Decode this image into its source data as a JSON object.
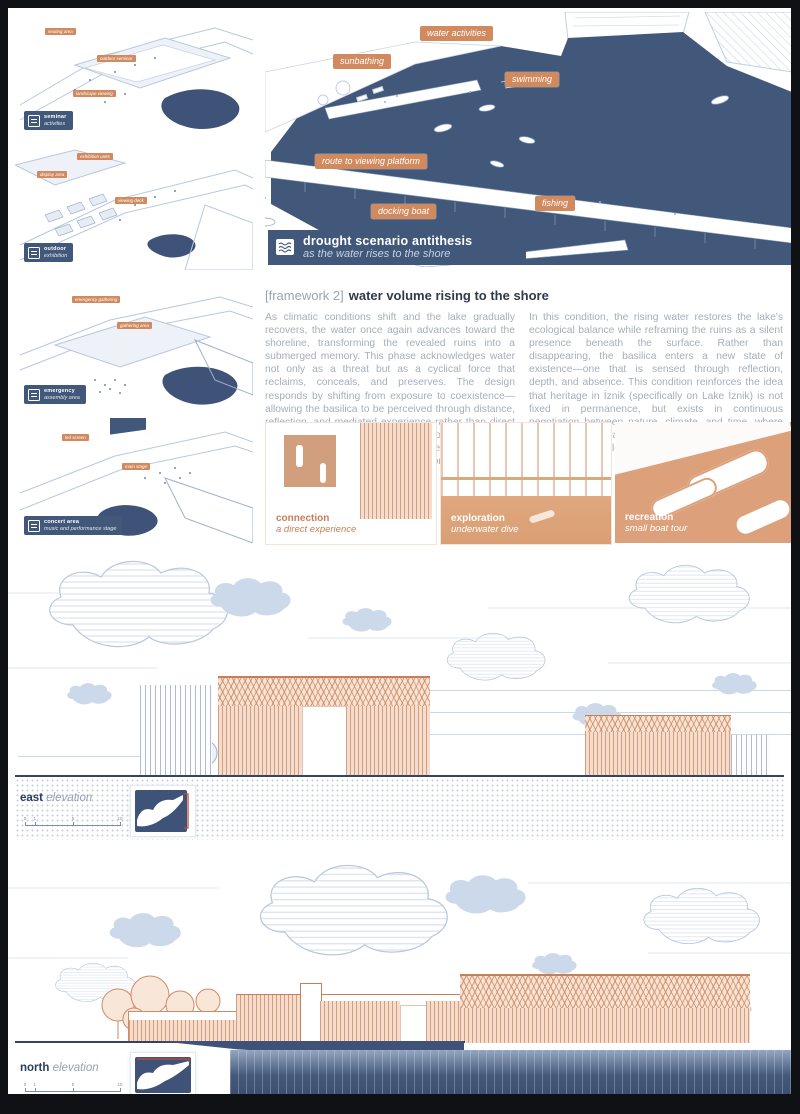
{
  "sidebar_thumbs": [
    {
      "badge": {
        "title": "seminar",
        "subtitle": "activities"
      },
      "tags": [
        "seating area",
        "outdoor seminar",
        "landscape viewing"
      ]
    },
    {
      "badge": {
        "title": "outdoor",
        "subtitle": "exhibition"
      },
      "tags": [
        "exhibition units",
        "display area",
        "viewing deck"
      ]
    },
    {
      "badge": {
        "title": "emergency",
        "subtitle": "assembly area"
      },
      "tags": [
        "emergency gathering",
        "gathering area"
      ]
    },
    {
      "badge": {
        "title": "concert area",
        "subtitle": "music and performance stage"
      },
      "tags": [
        "led screen",
        "main stage"
      ]
    }
  ],
  "main_diagram": {
    "tags": [
      {
        "label": "water activities"
      },
      {
        "label": "sunbathing"
      },
      {
        "label": "swimming"
      },
      {
        "label": "route to viewing platform"
      },
      {
        "label": "docking boat"
      },
      {
        "label": "fishing"
      }
    ],
    "banner": {
      "icon": "waves-icon",
      "title": "drought scenario antithesis",
      "subtitle": "as the water rises to the shore"
    }
  },
  "framework": {
    "prefix": "[framework 2]",
    "title": "water volume rising to the shore",
    "col_left": "As climatic conditions shift and the lake gradually recovers, the water once again advances toward the shoreline, transforming the revealed ruins into a submerged memory. This phase acknowledges water not only as a threat but as a cyclical force that reclaims, conceals, and preserves. The design responds by shifting from exposure to coexistence—allowing the basilica to be perceived through distance, reflection, and mediated experience rather than direct access. Floating paths, viewing platforms, and water-based activities redefine human interaction with the site, emphasizing thorough observation.",
    "col_right": "In this condition, the rising water restores the lake's ecological balance while reframing the ruins as a silent presence beneath the surface. Rather than disappearing, the basilica enters a new state of existence—one that is sensed through reflection, depth, and absence. This condition reinforces the idea that heritage in İznik (specifically on Lake İznik) is not fixed in permanence, but exists in continuous negotiation between nature, climate, and time, where heritage preservation is shaped as much by environmental cycles as by human intervention."
  },
  "experience_thumbs": [
    {
      "title": "connection",
      "subtitle": "a direct experience"
    },
    {
      "title": "exploration",
      "subtitle": "underwater dive"
    },
    {
      "title": "recreation",
      "subtitle": "small boat tour"
    }
  ],
  "elevations": {
    "east": {
      "label_bold": "east",
      "label_italic": "elevation",
      "scale_ticks": [
        "0",
        "1",
        "5",
        "10"
      ]
    },
    "north": {
      "label_bold": "north",
      "label_italic": "elevation",
      "scale_ticks": [
        "0",
        "1",
        "5",
        "10"
      ]
    }
  },
  "colors": {
    "water": "#41587b",
    "tag_orange": "#d18a5e",
    "peach": "#f4ddcc",
    "line_blue": "#b9c7de",
    "red_accent": "#c34a3d"
  }
}
